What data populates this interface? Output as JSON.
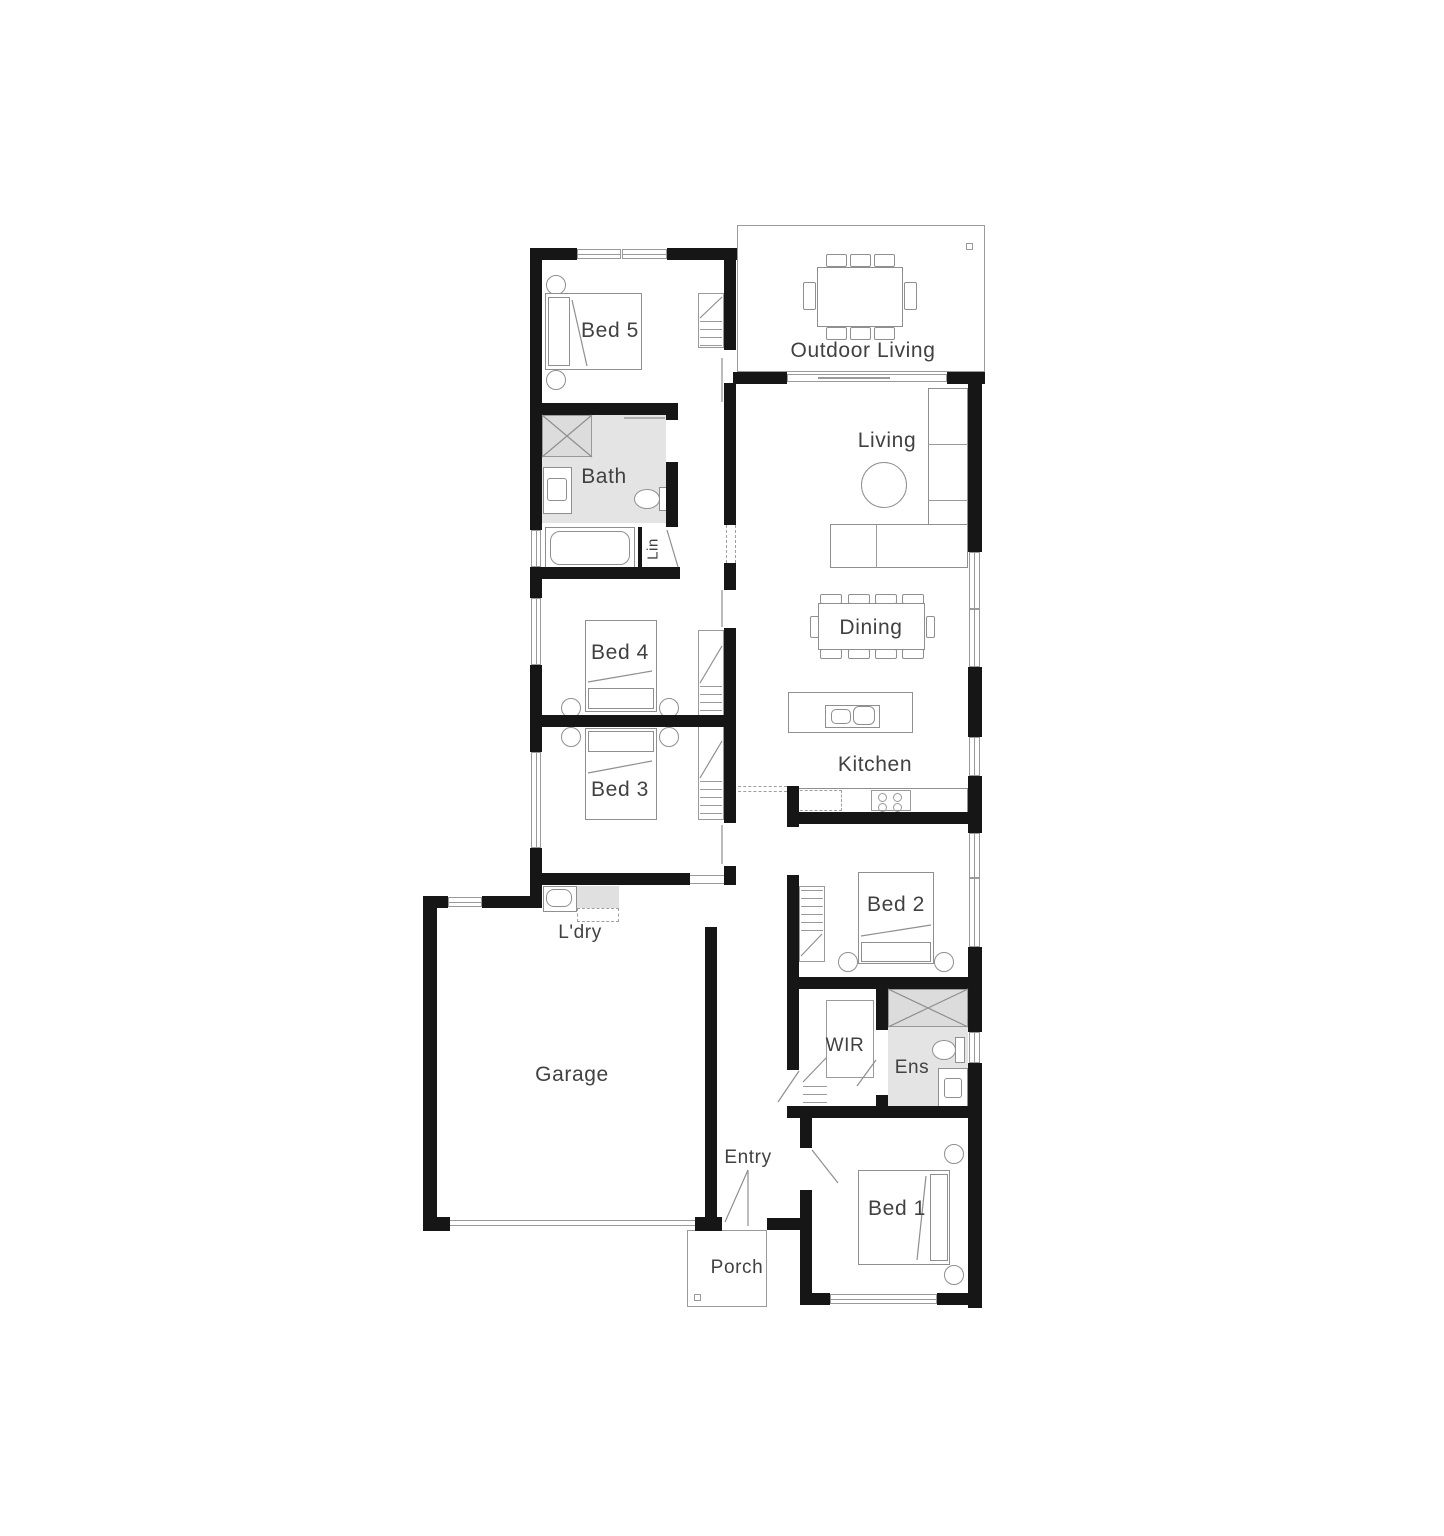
{
  "plan": {
    "title": "House floor plan",
    "rooms": {
      "bed5": {
        "label": "Bed 5"
      },
      "outdoor_living": {
        "label": "Outdoor Living"
      },
      "living": {
        "label": "Living"
      },
      "bath": {
        "label": "Bath"
      },
      "lin": {
        "label": "Lin"
      },
      "dining": {
        "label": "Dining"
      },
      "bed4": {
        "label": "Bed 4"
      },
      "bed3": {
        "label": "Bed 3"
      },
      "kitchen": {
        "label": "Kitchen"
      },
      "ldry": {
        "label": "L'dry"
      },
      "bed2": {
        "label": "Bed 2"
      },
      "garage": {
        "label": "Garage"
      },
      "wir": {
        "label": "WIR"
      },
      "ens": {
        "label": "Ens"
      },
      "entry": {
        "label": "Entry"
      },
      "bed1": {
        "label": "Bed 1"
      },
      "porch": {
        "label": "Porch"
      }
    },
    "colors": {
      "wall": "#161616",
      "wet_area": "#e4e4e4",
      "furniture_line": "#8f8f8f",
      "window_line": "#999999",
      "text": "#414141",
      "background": "#ffffff"
    }
  }
}
